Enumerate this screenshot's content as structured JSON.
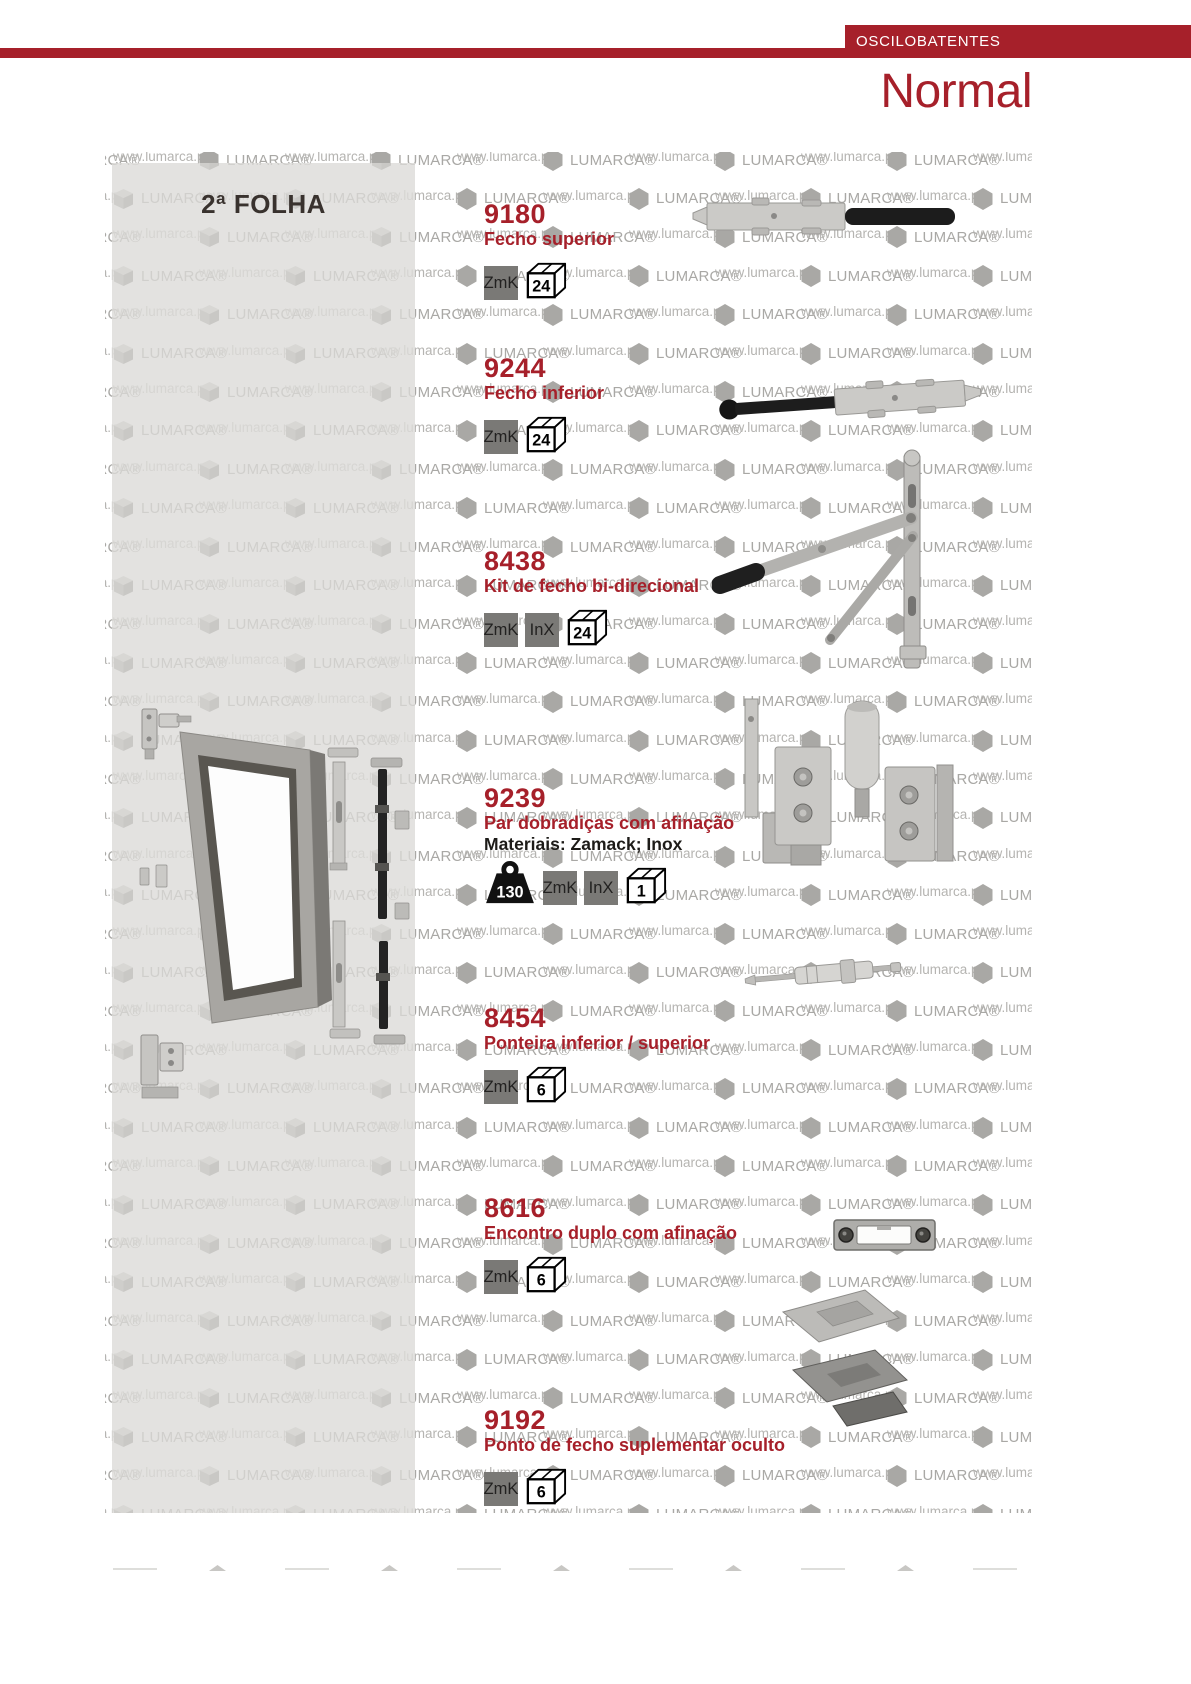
{
  "header": {
    "category_tab": "OSCILOBATENTES",
    "page_title": "Normal"
  },
  "left_panel": {
    "section_title": "2ª FOLHA"
  },
  "watermark": {
    "url_text": "www.lumarca.pt",
    "brand_text": "LUMARCA®"
  },
  "colors": {
    "accent_red": "#a6202a",
    "title_red": "#a6202a",
    "badge_gray": "#7a7976",
    "panel_gray": "#e3e2e0"
  },
  "products": [
    {
      "code": "9180",
      "name": "Fecho superior",
      "material_badges": [
        "ZmK"
      ],
      "box_qty": "24"
    },
    {
      "code": "9244",
      "name": "Fecho inferior",
      "material_badges": [
        "ZmK"
      ],
      "box_qty": "24"
    },
    {
      "code": "8438",
      "name": "Kit de fecho bi-direcional",
      "material_badges": [
        "ZmK",
        "InX"
      ],
      "box_qty": "24"
    },
    {
      "code": "9239",
      "name": "Par dobradiças com afinação",
      "materials_note": "Materiais: Zamack; Inox",
      "weight": "130",
      "material_badges": [
        "ZmK",
        "InX"
      ],
      "box_qty": "1"
    },
    {
      "code": "8454",
      "name": "Ponteira inferior / superior",
      "material_badges": [
        "ZmK"
      ],
      "box_qty": "6"
    },
    {
      "code": "8616",
      "name": "Encontro duplo com afinação",
      "material_badges": [
        "ZmK"
      ],
      "box_qty": "6"
    },
    {
      "code": "9192",
      "name": "Ponto de fecho suplementar oculto",
      "material_badges": [
        "ZmK"
      ],
      "box_qty": "6"
    }
  ]
}
